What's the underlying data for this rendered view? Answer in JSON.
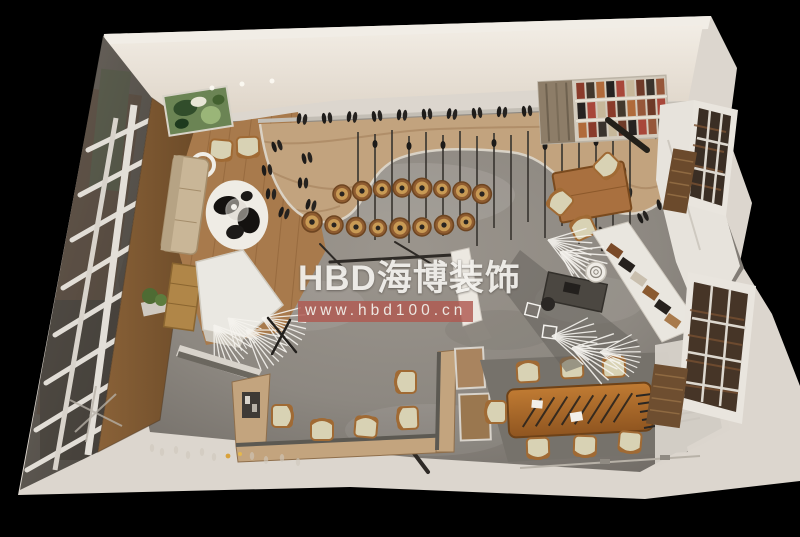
{
  "watermark": {
    "brand": "HBD海博装饰",
    "url": "www.hbd100.cn",
    "brand_color": "#f3f1ed",
    "band_color": "#b05951"
  },
  "palette": {
    "background": "#000000",
    "wall_white": "#e8e2d8",
    "concrete_floor": "#8d8881",
    "display_wood": "#c2a37e",
    "plank_wood": "#a87a4c",
    "conference_wood": "#b5722f",
    "cushion_beige": "#d8d2b4",
    "glass_dark": "#55504a",
    "accent_red": "#b05951"
  },
  "scene": {
    "type": "3d-interior-render-top-down",
    "areas": [
      "lounge with sofa, cowhide rug and green artwork",
      "curved wooden shoe display wall",
      "log-stump display pedestals",
      "glass storefront facade",
      "white reception desk with feather decor",
      "u-shaped wooden counter with chairs",
      "conference table with eight chairs",
      "bookshelf and office desk",
      "side windows with display racks"
    ]
  }
}
